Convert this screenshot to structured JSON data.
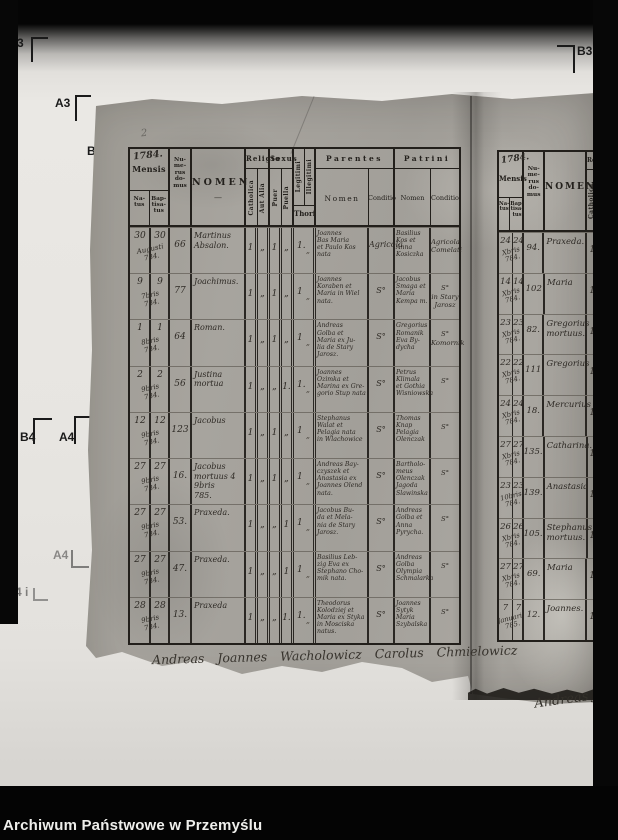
{
  "colors": {
    "background": "#060606",
    "film": "#e8e6e2",
    "paper": "#a5a29c",
    "ink": "#23201c",
    "handwriting": "#2f2b26",
    "caption_text": "#efefec"
  },
  "frame": {
    "archive_label": "Archiwum Państwowe w Przemyślu",
    "pencil_note": "2",
    "crop_marks": {
      "top_left_3": "3",
      "top_left_a3": "A3",
      "partial_b": "B.",
      "top_right_b3": "B3",
      "mid_b4": "B4",
      "mid_a4": "A4",
      "lower_a4": "A4",
      "bottom_4i": "4 i"
    }
  },
  "left_page": {
    "year_note": "1784.",
    "header": {
      "mensis": "Mensis",
      "natus": "Na-\ntus",
      "baptisatus": "Bap-\ntisa-\ntus",
      "numerus_domus": "Nu-\nme-\nrus\ndo-\nmus",
      "nomen": "NOMEN",
      "nomen_flourish": "—",
      "religio": "Religio",
      "catholica": "Catholica",
      "aut_alia": "Aut Alia",
      "sexus": "Sexus",
      "puer": "Puer",
      "puella": "Puella",
      "legitimi": "Legitimi",
      "illegitimi": "Illegitimi",
      "thori": "Thori",
      "parentes": "Parentes",
      "patrini": "Patrini",
      "nomen_sub": "Nomen",
      "conditio": "Conditio"
    },
    "rows": [
      {
        "natus": "30",
        "baptisatus": "30",
        "month": "Augusti\n784.",
        "domus": "66",
        "name": "Martinus\nAbsalon.",
        "catholica": "1",
        "aut_alia": "„",
        "puer": "1",
        "puella": "„",
        "legitimi": "1.",
        "illegitimi": "„",
        "parentes_nomen": "Joannes\nBas Maria\net Paulo Kos\nnata",
        "parentes_conditio": "Agricola",
        "patrini_nomen": "Basilius\nKos et\nAnna\nKosiczka",
        "patrini_conditio": "Agricola\nComelati"
      },
      {
        "natus": "9",
        "baptisatus": "9",
        "month": "7bris\n784.",
        "domus": "77",
        "name": "Joachimus.",
        "catholica": "1",
        "aut_alia": "„",
        "puer": "1",
        "puella": "„",
        "legitimi": "1",
        "illegitimi": "„",
        "parentes_nomen": "Joannes\nKoraben et\nMaria in Wiel\nnata.",
        "parentes_conditio": "S°",
        "patrini_nomen": "Jacobus\nSmaga et\nMaria\nKempa m.",
        "patrini_conditio": "S°\nin Stary\nJarosz"
      },
      {
        "natus": "1",
        "baptisatus": "1",
        "month": "8bris\n784.",
        "domus": "64",
        "name": "Roman.",
        "catholica": "1",
        "aut_alia": "„",
        "puer": "1",
        "puella": "„",
        "legitimi": "1",
        "illegitimi": "„",
        "parentes_nomen": "Andreas\nGolba et\nMaria ex Ju-\nlia de Stary\nJarosz.",
        "parentes_conditio": "S°",
        "patrini_nomen": "Gregorius\nRomanik\nEva By-\ndycha",
        "patrini_conditio": "S°\nKomornik"
      },
      {
        "natus": "2",
        "baptisatus": "2",
        "month": "9bris\n784.",
        "domus": "56",
        "name": "Justina\nmortua",
        "catholica": "1",
        "aut_alia": "„",
        "puer": "„",
        "puella": "1.",
        "legitimi": "1.",
        "illegitimi": "„",
        "parentes_nomen": "Joannes\nOzimka et\nMarina ex Gre-\ngorio Stup nata",
        "parentes_conditio": "S°",
        "patrini_nomen": "Petrus\nKlimala\net Gothia\nWisniowska",
        "patrini_conditio": "S°"
      },
      {
        "natus": "12",
        "baptisatus": "12",
        "month": "9bris\n784.",
        "domus": "123",
        "name": "Jacobus",
        "catholica": "1",
        "aut_alia": "„",
        "puer": "1",
        "puella": "„",
        "legitimi": "1",
        "illegitimi": "„",
        "parentes_nomen": "Stephanus\nWalat et\nPelagia nata\nin Wlachowice",
        "parentes_conditio": "S°",
        "patrini_nomen": "Thomas\nKnap\nPelagia\nOlenczak",
        "patrini_conditio": "S°"
      },
      {
        "natus": "27",
        "baptisatus": "27",
        "month": "9bris\n784.",
        "domus": "16.",
        "name": "Jacobus\nmortuus 4\n9bris\n785.",
        "catholica": "1",
        "aut_alia": "„",
        "puer": "1",
        "puella": "„",
        "legitimi": "1",
        "illegitimi": "„",
        "parentes_nomen": "Andreas Bay-\nczyszek et\nAnastasia ex\nJoannes Olend\nnata.",
        "parentes_conditio": "S°",
        "patrini_nomen": "Bartholo-\nmeus\nOlenczak\nJagoda\nSlawinska",
        "patrini_conditio": "S°"
      },
      {
        "natus": "27",
        "baptisatus": "27",
        "month": "9bris\n784.",
        "domus": "53.",
        "name": "Praxeda.",
        "catholica": "1",
        "aut_alia": "„",
        "puer": "„",
        "puella": "1",
        "legitimi": "1",
        "illegitimi": "„",
        "parentes_nomen": "Jacobus Bu-\nda et Mela-\nnia de Stary\nJarosz.",
        "parentes_conditio": "S°",
        "patrini_nomen": "Andreas\nGolba et\nAnna\nPyrycha.",
        "patrini_conditio": "S°"
      },
      {
        "natus": "27",
        "baptisatus": "27",
        "month": "9bris\n784.",
        "domus": "47.",
        "name": "Praxeda.",
        "catholica": "1",
        "aut_alia": "„",
        "puer": "„",
        "puella": "1",
        "legitimi": "1",
        "illegitimi": "„",
        "parentes_nomen": "Basilius Leb-\nzig Eva ex\nStephano Cho-\nmik nata.",
        "parentes_conditio": "S°",
        "patrini_nomen": "Andreas\nGolba\nOlympia\nSchmalarka",
        "patrini_conditio": "S°"
      },
      {
        "natus": "28",
        "baptisatus": "28",
        "month": "9bris\n784.",
        "domus": "13.",
        "name": "Praxeda",
        "catholica": "1",
        "aut_alia": "„",
        "puer": "„",
        "puella": "1.",
        "legitimi": "1.",
        "illegitimi": "„",
        "parentes_nomen": "Theodorus\nKolodziej et\nMaria ex Styka\nin Mosciska\nnatus.",
        "parentes_conditio": "S°",
        "patrini_nomen": "Joannes\nSytyk\nMaria\nSzybalska",
        "patrini_conditio": "S°"
      }
    ],
    "signature": "Andreas Joannes Wacholowicz Carolus Chmielowicz"
  },
  "right_page": {
    "year_note": "1784.",
    "header": {
      "mensis": "Mensis",
      "natus": "Na-\ntus",
      "baptisatus": "Bap-\ntisa-\ntus",
      "numerus_domus": "Nu-\nme-\nrus\ndo-\nmus",
      "nomen": "NOMEN",
      "religio_partial": "Re",
      "catholica": "Catholica."
    },
    "rows": [
      {
        "natus": "24",
        "baptisatus": "24",
        "month": "Xbris\n784.",
        "domus": "94.",
        "name": "Praxeda.",
        "catholica": "1"
      },
      {
        "natus": "14",
        "baptisatus": "14",
        "month": "Xbris\n784.",
        "domus": "102",
        "name": "Maria",
        "catholica": "1"
      },
      {
        "natus": "23",
        "baptisatus": "23",
        "month": "Xbris\n784.",
        "domus": "82.",
        "name": "Gregorius\nmortuus.",
        "catholica": "1"
      },
      {
        "natus": "22",
        "baptisatus": "22",
        "month": "Xbris\n784.",
        "domus": "111",
        "name": "Gregorius",
        "catholica": "1"
      },
      {
        "natus": "24",
        "baptisatus": "24",
        "month": "Xbris\n784.",
        "domus": "18.",
        "name": "Mercurius",
        "catholica": "1"
      },
      {
        "natus": "27",
        "baptisatus": "27",
        "month": "Xbris\n784.",
        "domus": "135.",
        "name": "Catharina.",
        "catholica": "1"
      },
      {
        "natus": "23",
        "baptisatus": "23",
        "month": "10bris\n784.",
        "domus": "139.",
        "name": "Anastasia",
        "catholica": "1"
      },
      {
        "natus": "26",
        "baptisatus": "26",
        "month": "Xbris\n784.",
        "domus": "105.",
        "name": "Stephanus\nmortuus.",
        "catholica": "1"
      },
      {
        "natus": "27",
        "baptisatus": "27",
        "month": "Xbris\n784.",
        "domus": "69.",
        "name": "Maria",
        "catholica": "1"
      },
      {
        "natus": "7",
        "baptisatus": "7",
        "month": "Januarii\n785.",
        "domus": "12.",
        "name": "Joannes.",
        "catholica": "1"
      }
    ],
    "signature_partial": "Andreas Joann"
  }
}
